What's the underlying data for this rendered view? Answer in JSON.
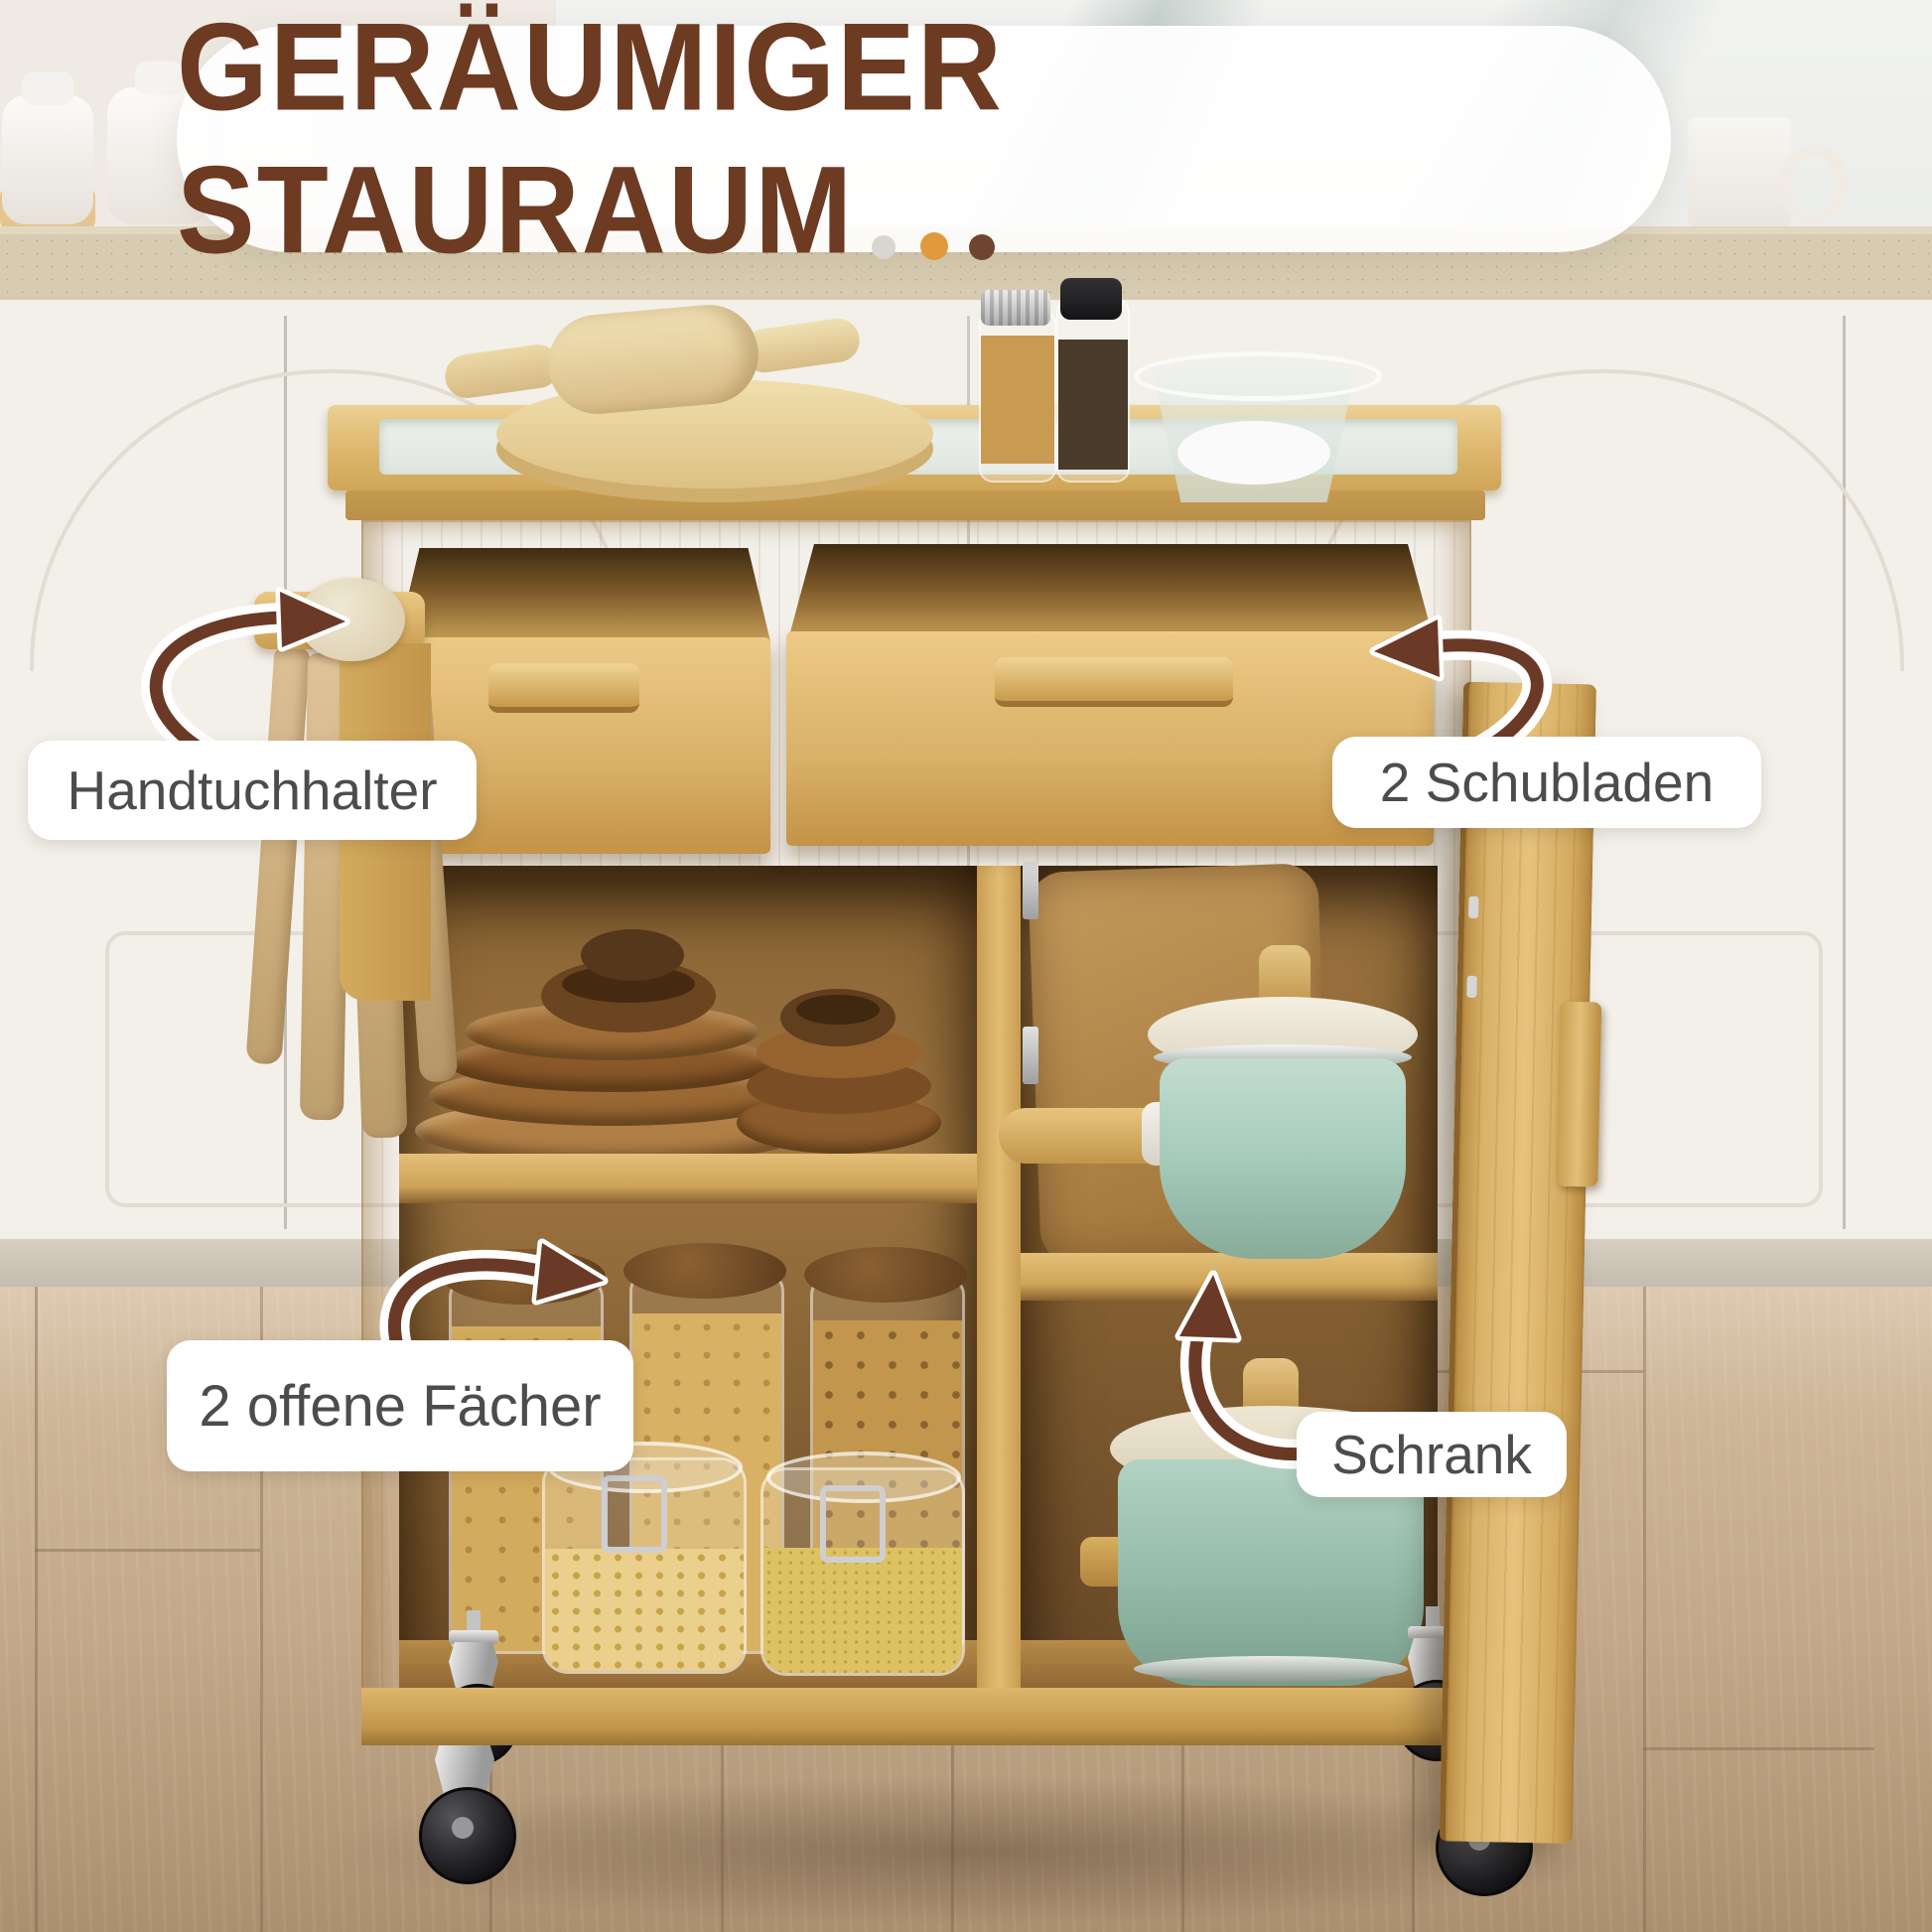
{
  "banner": {
    "title": "GERÄUMIGER STAURAUM",
    "dots": [
      "#d9d6d2",
      "#e09a3c",
      "#6f4430"
    ]
  },
  "callouts": {
    "towel_holder": "Handtuchhalter",
    "drawers": "2 Schubladen",
    "open_shelves": "2 offene Fächer",
    "cabinet": "Schrank"
  },
  "colors": {
    "title_brown": "#6d3a22",
    "label_text": "#4c4c4c",
    "arrow_brown": "#6b3a26",
    "bamboo_wood": "#d9b168",
    "teal_cookware": "#a6cbbb",
    "floor_oak": "#c3ab8d"
  }
}
